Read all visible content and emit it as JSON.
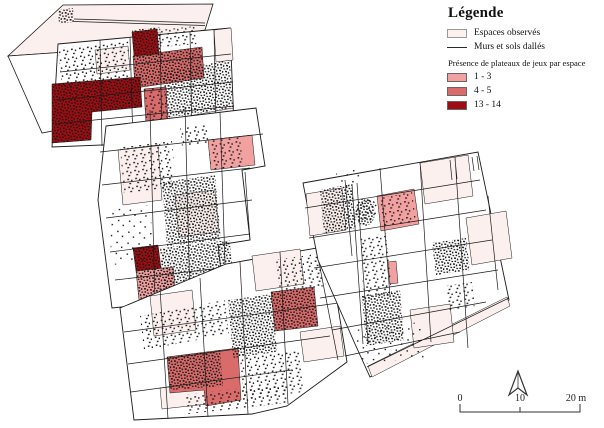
{
  "legend": {
    "title": "Légende",
    "observed": {
      "label": "Espaces observés",
      "color": "#fbf0ee"
    },
    "walls": {
      "label": "Murs et sols dallés",
      "color": "#2a2a2a"
    },
    "classes_title": "Présence de plateaux de jeux par espace",
    "classes": [
      {
        "label": "1 - 3",
        "color": "#f2a1a1"
      },
      {
        "label": "4 - 5",
        "color": "#d96b6b"
      },
      {
        "label": "13 - 14",
        "color": "#9e0d12"
      }
    ]
  },
  "scalebar": {
    "ticks": [
      "0",
      "10",
      "20 m"
    ]
  }
}
